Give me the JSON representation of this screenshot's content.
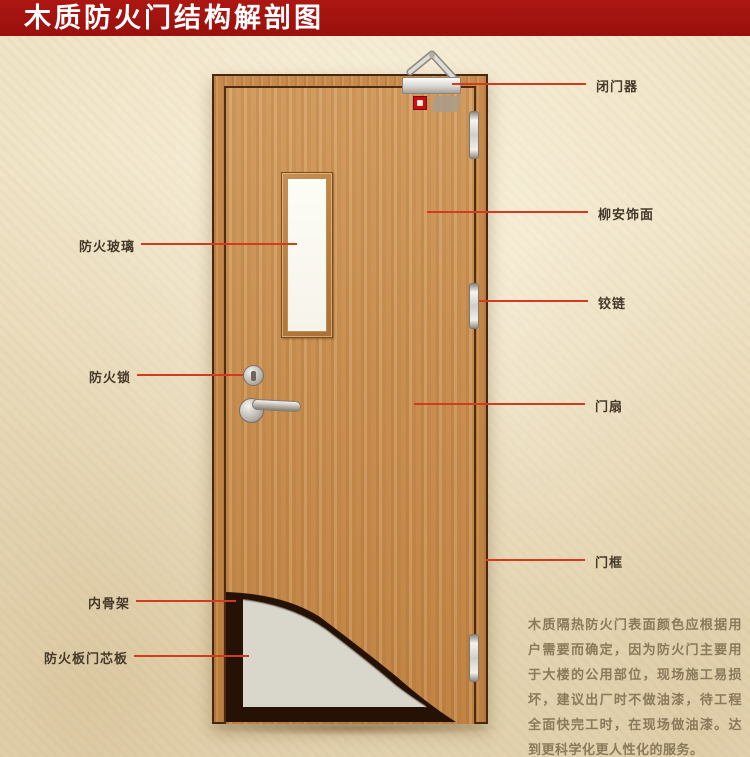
{
  "title": {
    "text": "木质防火门结构解剖图"
  },
  "callouts": {
    "left": [
      {
        "label": "防火玻璃"
      },
      {
        "label": "防火锁"
      },
      {
        "label": "内骨架"
      },
      {
        "label": "防火板门芯板"
      }
    ],
    "right": [
      {
        "label": "闭门器"
      },
      {
        "label": "柳安饰面"
      },
      {
        "label": "铰链"
      },
      {
        "label": "门扇"
      },
      {
        "label": "门框"
      }
    ]
  },
  "description": {
    "text": "木质隔热防火门表面颜色应根据用户需要而确定，因为防火门主要用于大楼的公用部位，现场施工易损坏，建议出厂时不做油漆，待工程全面快完工时，在现场做油漆。达到更科学化更人性化的服务。"
  },
  "colors": {
    "banner": "#a41411",
    "leader_line": "#d23c1e",
    "door_wood": "#c98f51",
    "core_panel": "#d9d6cc",
    "inner_skeleton": "#261204",
    "background": "#f0e4c7"
  }
}
